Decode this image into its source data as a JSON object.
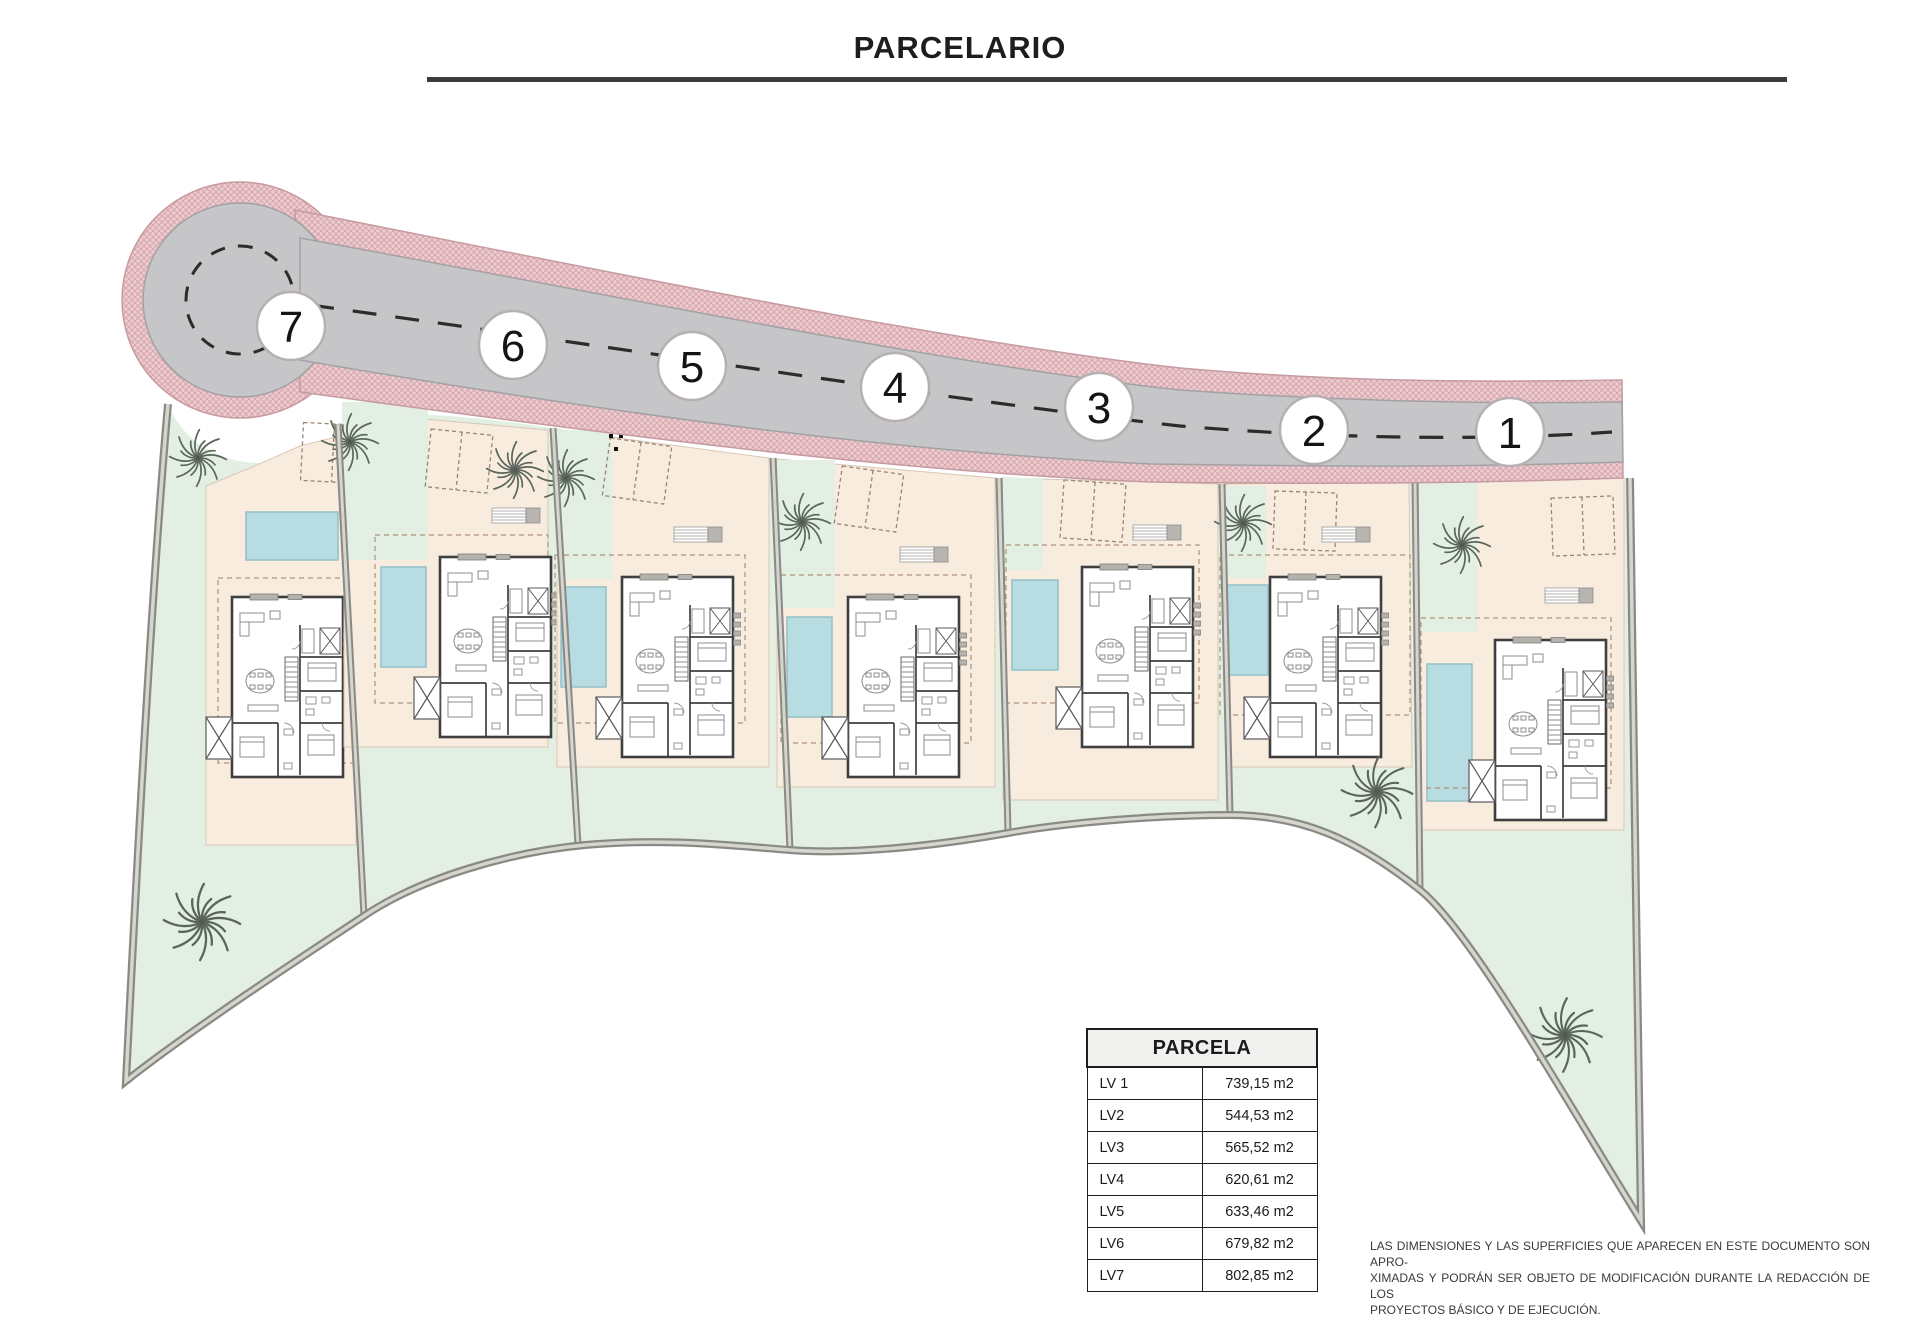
{
  "title": "PARCELARIO",
  "plan": {
    "road_markers": [
      {
        "label": "7",
        "x": 291,
        "y": 326
      },
      {
        "label": "6",
        "x": 513,
        "y": 345
      },
      {
        "label": "5",
        "x": 692,
        "y": 366
      },
      {
        "label": "4",
        "x": 895,
        "y": 387
      },
      {
        "label": "3",
        "x": 1099,
        "y": 407
      },
      {
        "label": "2",
        "x": 1314,
        "y": 430
      },
      {
        "label": "1",
        "x": 1510,
        "y": 432
      }
    ]
  },
  "table": {
    "title": "PARCELA",
    "rows": [
      {
        "label": "LV 1",
        "value": "739,15 m2"
      },
      {
        "label": "LV2",
        "value": "544,53 m2"
      },
      {
        "label": "LV3",
        "value": "565,52 m2"
      },
      {
        "label": "LV4",
        "value": "620,61 m2"
      },
      {
        "label": "LV5",
        "value": "633,46 m2"
      },
      {
        "label": "LV6",
        "value": "679,82 m2"
      },
      {
        "label": "LV7",
        "value": "802,85 m2"
      }
    ]
  },
  "disclaimer": {
    "lines": [
      "LAS DIMENSIONES Y LAS SUPERFICIES QUE APARECEN EN ESTE DOCUMENTO SON APRO-",
      "XIMADAS Y PODRÁN SER OBJETO DE MODIFICACIÓN DURANTE LA REDACCIÓN DE LOS",
      "PROYECTOS BÁSICO Y DE EJECUCIÓN."
    ]
  },
  "colors": {
    "road": "#c6c5c8",
    "road_edge": "#a2a1a4",
    "sidewalk_pink": "#ecccd0",
    "sidewalk_hatch": "#d5a3a9",
    "lawn": "#e3efe2",
    "terrace": "#f8ecdf",
    "pool": "#b7dce2",
    "boundary": "#8a8a85"
  }
}
